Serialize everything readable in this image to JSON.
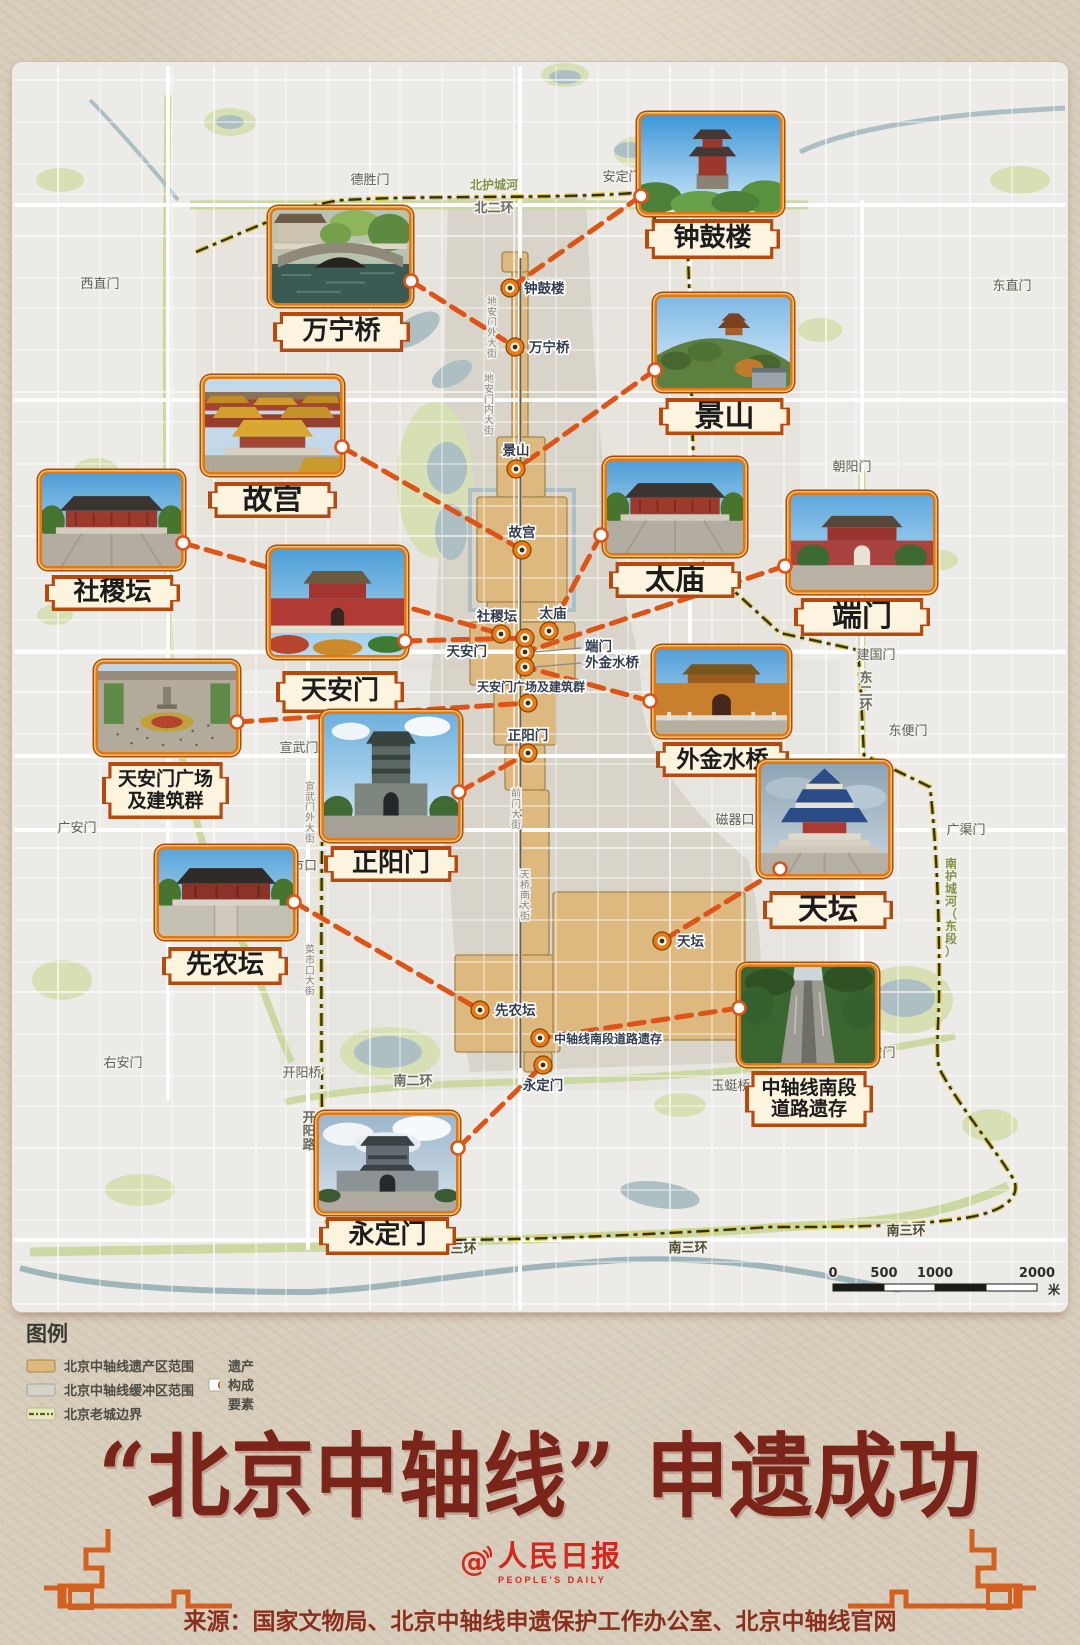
{
  "poster": {
    "title": "“北京中轴线” 申遗成功",
    "source": "来源：国家文物局、北京中轴线申遗保护工作办公室、北京中轴线官网",
    "logo_cn": "人民日报",
    "logo_en": "PEOPLE'S DAILY"
  },
  "legend": {
    "heading": "图例",
    "items": [
      {
        "label": "北京中轴线遗产区范围",
        "type": "heritage"
      },
      {
        "label": "北京中轴线缓冲区范围",
        "type": "buffer"
      },
      {
        "label": "北京老城边界",
        "type": "boundary"
      },
      {
        "label": "遗产构成要素",
        "type": "element"
      }
    ]
  },
  "scalebar": {
    "ticks": [
      "0",
      "500",
      "1000",
      "2000"
    ],
    "unit": "米"
  },
  "colors": {
    "accent_orange": "#de5417",
    "heritage_tan": "#ddb980",
    "buffer_gray": "#d6d1c7",
    "boundary_yellow": "#ddc93e",
    "title_red": "#7b241a",
    "logo_red": "#d4271d"
  },
  "sites": [
    {
      "id": "zhonggulou",
      "name": "钟鼓楼",
      "photo": "gate-red",
      "card": [
        637,
        112,
        147,
        104
      ],
      "label": [
        645,
        219,
        135,
        40
      ],
      "marker": [
        510,
        288
      ],
      "mlabel": {
        "x": 524,
        "y": 293,
        "a": "start"
      },
      "dot": [
        641,
        196
      ]
    },
    {
      "id": "wanningqiao",
      "name": "万宁桥",
      "photo": "bridge",
      "card": [
        268,
        206,
        145,
        101
      ],
      "label": [
        273,
        312,
        137,
        40
      ],
      "marker": [
        515,
        347
      ],
      "mlabel": {
        "x": 529,
        "y": 352,
        "a": "start"
      },
      "dot": [
        411,
        281
      ]
    },
    {
      "id": "jingshan",
      "name": "景山",
      "photo": "hill",
      "card": [
        653,
        293,
        141,
        99
      ],
      "label": [
        659,
        398,
        131,
        37
      ],
      "marker": [
        516,
        469
      ],
      "mlabel": {
        "x": 516,
        "y": 455,
        "a": "middle"
      },
      "dot": [
        655,
        370
      ]
    },
    {
      "id": "gugong",
      "name": "故宫",
      "photo": "roofs",
      "card": [
        201,
        375,
        143,
        101
      ],
      "label": [
        208,
        482,
        129,
        36
      ],
      "marker": [
        522,
        550
      ],
      "mlabel": {
        "x": 522,
        "y": 537,
        "a": "middle"
      },
      "dot": [
        342,
        447
      ]
    },
    {
      "id": "shejitan",
      "name": "社稷坛",
      "photo": "hall",
      "card": [
        38,
        470,
        147,
        100
      ],
      "label": [
        45,
        575,
        135,
        36
      ],
      "marker": [
        501,
        634
      ],
      "mlabel": {
        "x": 497,
        "y": 621,
        "a": "middle"
      },
      "dot": [
        183,
        543
      ]
    },
    {
      "id": "taimiao",
      "name": "太庙",
      "photo": "hall",
      "card": [
        603,
        457,
        144,
        100
      ],
      "label": [
        609,
        562,
        132,
        36
      ],
      "marker": [
        549,
        631
      ],
      "mlabel": {
        "x": 553,
        "y": 618,
        "a": "middle"
      },
      "dot": [
        601,
        535
      ]
    },
    {
      "id": "duanmen",
      "name": "端门",
      "photo": "gate-red2",
      "card": [
        787,
        491,
        150,
        103
      ],
      "label": [
        794,
        598,
        136,
        38
      ],
      "marker": [
        525,
        652
      ],
      "mlabel": {
        "x": 585,
        "y": 651,
        "a": "start",
        "leader": true
      },
      "dot": [
        785,
        566
      ]
    },
    {
      "id": "tiananmen",
      "name": "天安门",
      "photo": "gate-tam",
      "card": [
        267,
        546,
        141,
        113
      ],
      "label": [
        276,
        671,
        128,
        42
      ],
      "marker": [
        525,
        638
      ],
      "mlabel": {
        "x": 487,
        "y": 656,
        "a": "end"
      },
      "dot": [
        405,
        641
      ]
    },
    {
      "id": "guangchang",
      "name": "天安门广场及建筑群",
      "lines": [
        "天安门广场",
        "及建筑群"
      ],
      "photo": "square",
      "card": [
        94,
        660,
        146,
        96
      ],
      "label": [
        102,
        762,
        127,
        57
      ],
      "marker": [
        528,
        703
      ],
      "mlabel": {
        "x": 477,
        "y": 691,
        "a": "start",
        "size": 12
      },
      "dot": [
        237,
        722
      ]
    },
    {
      "id": "waijinshuiqiao",
      "name": "外金水桥",
      "photo": "gate-orange",
      "card": [
        652,
        645,
        139,
        93
      ],
      "label": [
        656,
        742,
        133,
        35
      ],
      "marker": [
        525,
        667
      ],
      "mlabel": {
        "x": 585,
        "y": 667,
        "a": "start",
        "leader": true
      },
      "dot": [
        650,
        701
      ]
    },
    {
      "id": "zhengyangmen",
      "name": "正阳门",
      "photo": "gate-gray",
      "card": [
        320,
        710,
        142,
        132
      ],
      "label": [
        324,
        846,
        134,
        36
      ],
      "marker": [
        528,
        753
      ],
      "mlabel": {
        "x": 528,
        "y": 740,
        "a": "middle"
      },
      "dot": [
        459,
        792
      ]
    },
    {
      "id": "xiannongtan",
      "name": "先农坛",
      "photo": "hall2",
      "card": [
        155,
        845,
        142,
        95
      ],
      "label": [
        162,
        947,
        126,
        38
      ],
      "marker": [
        480,
        1010
      ],
      "mlabel": {
        "x": 495,
        "y": 1015,
        "a": "start"
      },
      "dot": [
        294,
        902
      ]
    },
    {
      "id": "tiantan",
      "name": "天坛",
      "photo": "tiantan",
      "card": [
        757,
        760,
        135,
        118
      ],
      "label": [
        763,
        891,
        130,
        38
      ],
      "marker": [
        662,
        941
      ],
      "mlabel": {
        "x": 677,
        "y": 946,
        "a": "start"
      },
      "dot": [
        780,
        869
      ]
    },
    {
      "id": "nanduan",
      "name": "中轴线南段道路遗存",
      "lines": [
        "中轴线南段",
        "道路遗存"
      ],
      "photo": "road",
      "card": [
        737,
        963,
        142,
        104
      ],
      "label": [
        745,
        1071,
        128,
        56
      ],
      "marker": [
        540,
        1038
      ],
      "mlabel": {
        "x": 554,
        "y": 1043,
        "a": "start",
        "size": 12
      },
      "dot": [
        739,
        1008
      ]
    },
    {
      "id": "yongdingmen",
      "name": "永定门",
      "photo": "gate-gray2",
      "card": [
        315,
        1111,
        145,
        104
      ],
      "label": [
        319,
        1217,
        137,
        38
      ],
      "marker": [
        543,
        1065
      ],
      "mlabel": {
        "x": 543,
        "y": 1090,
        "a": "middle"
      },
      "dot": [
        458,
        1148
      ]
    }
  ],
  "map_labels": [
    {
      "t": "德胜门",
      "x": 370,
      "y": 184,
      "cls": "gate"
    },
    {
      "t": "安定门",
      "x": 622,
      "y": 181,
      "cls": "gate"
    },
    {
      "t": "北护城河",
      "x": 494,
      "y": 189,
      "cls": "river"
    },
    {
      "t": "北二环",
      "x": 494,
      "y": 212,
      "cls": "road"
    },
    {
      "t": "西直门",
      "x": 100,
      "y": 288,
      "cls": "gate"
    },
    {
      "t": "东直门",
      "x": 1012,
      "y": 290,
      "cls": "gate"
    },
    {
      "t": "朝阳门",
      "x": 852,
      "y": 471,
      "cls": "gate"
    },
    {
      "t": "建国门",
      "x": 876,
      "y": 659,
      "cls": "gate"
    },
    {
      "t": "东二环",
      "x": 866,
      "y": 682,
      "cls": "road",
      "v": true
    },
    {
      "t": "东便门",
      "x": 908,
      "y": 735,
      "cls": "gate"
    },
    {
      "t": "广渠门",
      "x": 966,
      "y": 834,
      "cls": "gate"
    },
    {
      "t": "南护城河（东段）",
      "x": 951,
      "y": 868,
      "cls": "river",
      "v": true
    },
    {
      "t": "广安门",
      "x": 77,
      "y": 832,
      "cls": "gate"
    },
    {
      "t": "磁器口",
      "x": 735,
      "y": 824,
      "cls": "gate"
    },
    {
      "t": "宣武门",
      "x": 299,
      "y": 752,
      "cls": "gate"
    },
    {
      "t": "右安门",
      "x": 123,
      "y": 1067,
      "cls": "gate"
    },
    {
      "t": "左安门",
      "x": 876,
      "y": 1057,
      "cls": "gate"
    },
    {
      "t": "开阳桥",
      "x": 302,
      "y": 1077,
      "cls": "gate"
    },
    {
      "t": "南二环",
      "x": 413,
      "y": 1085,
      "cls": "road"
    },
    {
      "t": "开阳路",
      "x": 309,
      "y": 1122,
      "cls": "road",
      "v": true
    },
    {
      "t": "玉蜓桥",
      "x": 731,
      "y": 1090,
      "cls": "gate"
    },
    {
      "t": "南三环",
      "x": 457,
      "y": 1253,
      "cls": "road3"
    },
    {
      "t": "南三环",
      "x": 688,
      "y": 1252,
      "cls": "road3"
    },
    {
      "t": "南三环",
      "x": 906,
      "y": 1235,
      "cls": "road3"
    },
    {
      "t": "地安门外大街",
      "x": 492,
      "y": 305,
      "cls": "st",
      "v": true
    },
    {
      "t": "地安门内大街",
      "x": 489,
      "y": 382,
      "cls": "st",
      "v": true
    },
    {
      "t": "前门大街",
      "x": 516,
      "y": 797,
      "cls": "st",
      "v": true
    },
    {
      "t": "天桥南大街",
      "x": 525,
      "y": 878,
      "cls": "st",
      "v": true
    },
    {
      "t": "宣武门外大街",
      "x": 310,
      "y": 790,
      "cls": "st",
      "v": true
    },
    {
      "t": "菜市口大街",
      "x": 310,
      "y": 953,
      "cls": "st",
      "v": true
    },
    {
      "t": "市口",
      "x": 304,
      "y": 870,
      "cls": "gate"
    }
  ]
}
